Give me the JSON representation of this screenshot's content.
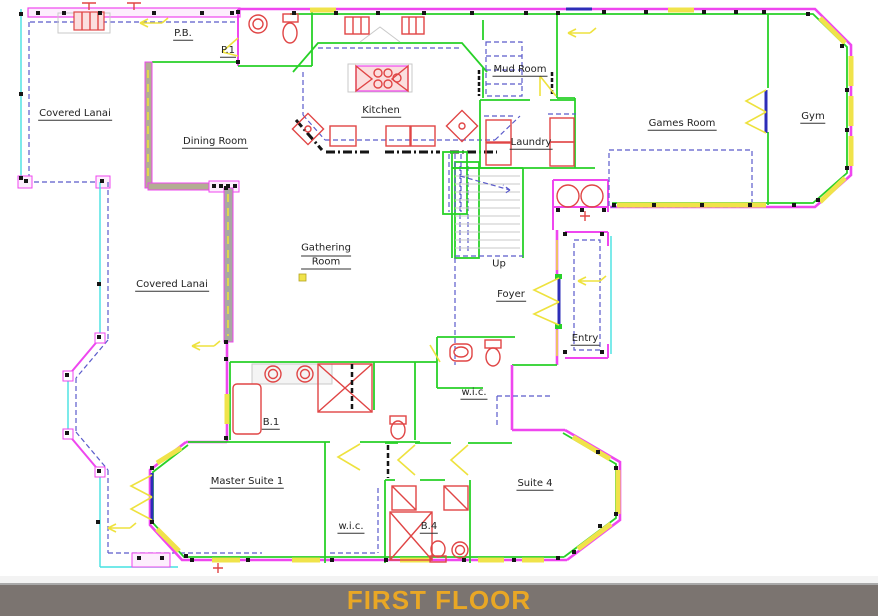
{
  "title_bar": {
    "label": "FIRST FLOOR"
  },
  "rooms": {
    "covered_lanai_top": "Covered Lanai",
    "pb": "P.B.",
    "p1": "P.1",
    "dining": "Dining Room",
    "kitchen": "Kitchen",
    "mud_room": "Mud Room",
    "laundry": "Laundry",
    "games_room": "Games Room",
    "gym": "Gym",
    "gathering_1": "Gathering",
    "gathering_2": "Room",
    "up": "Up",
    "foyer": "Foyer",
    "entry": "Entry",
    "covered_lanai_left": "Covered Lanai",
    "b1": "B.1",
    "wic_foyer": "w.i.c.",
    "master_suite_1": "Master Suite 1",
    "wic_master": "w.i.c.",
    "b4": "B.4",
    "suite_4": "Suite 4"
  },
  "colors": {
    "wall_magenta": "#ef46ef",
    "wall_green": "#28d128",
    "screen_cyan": "#45e2e2",
    "casework_blue": "#5b5bcb",
    "door_blue": "#2d2db8",
    "glass_yellow": "#f0e34a",
    "fixture_red": "#e04545",
    "stair_gray": "#c9c9c9",
    "banner_bg": "#7b7470",
    "banner_text": "#e9a725"
  }
}
